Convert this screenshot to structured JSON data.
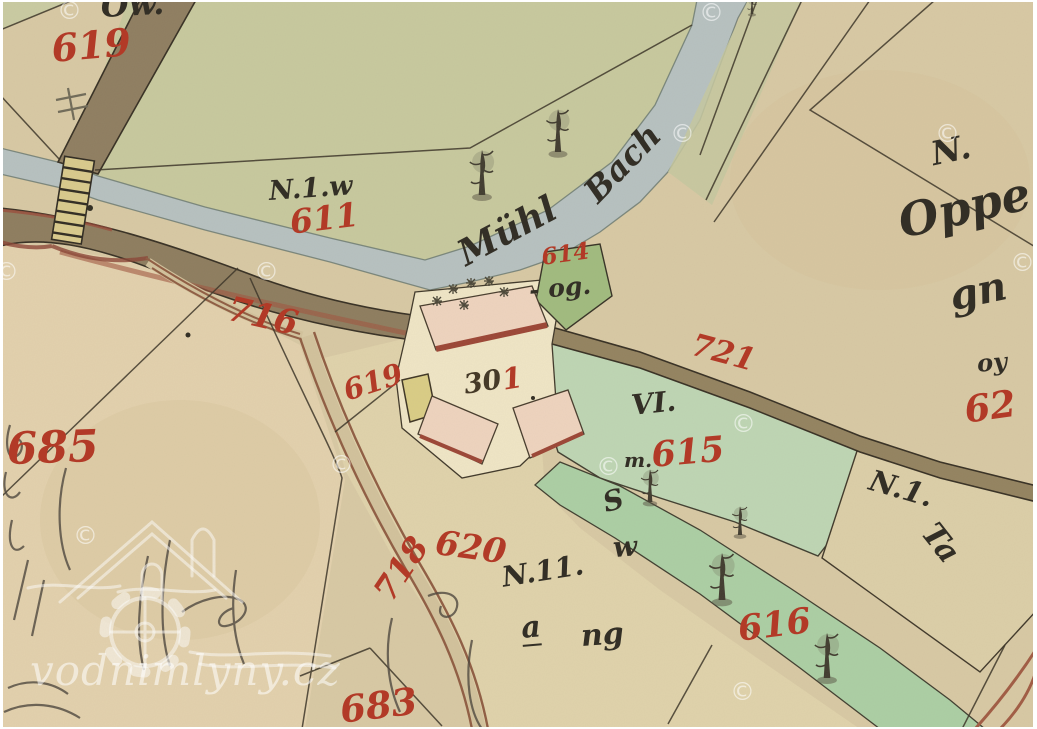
{
  "watermark": {
    "site": "vodnimlyny.cz",
    "copyright": "©"
  },
  "labels": {
    "parcel_619_top": "619",
    "parcel_611": "611",
    "road_716": "716",
    "parcel_614": "614",
    "parcel_og": "- og.",
    "parcel_619_mid": "619",
    "house_301_black": "30",
    "house_301_red": "1",
    "road_721": "721",
    "parcel_62": "62",
    "parcel_615_prefix": "m.",
    "parcel_615": "615",
    "parcel_vi": "VI.",
    "parcel_685": "685",
    "parcel_620": "620",
    "road_718": "718",
    "parcel_683": "683",
    "parcel_616": "616",
    "stream_name_1": "Mühl",
    "stream_name_2": "Bach",
    "note_ow": "Ow.",
    "note_n1w": "N.1.w",
    "note_n_topright": "N.",
    "note_oppe": "Oppe",
    "note_gn": "gn",
    "note_oy": "oy",
    "note_s": "S",
    "note_w": "w",
    "note_n11": "N.11.",
    "note_a": "a",
    "note_ng": "ng",
    "note_n1_right": "N.1.",
    "note_ta": "Ta"
  }
}
